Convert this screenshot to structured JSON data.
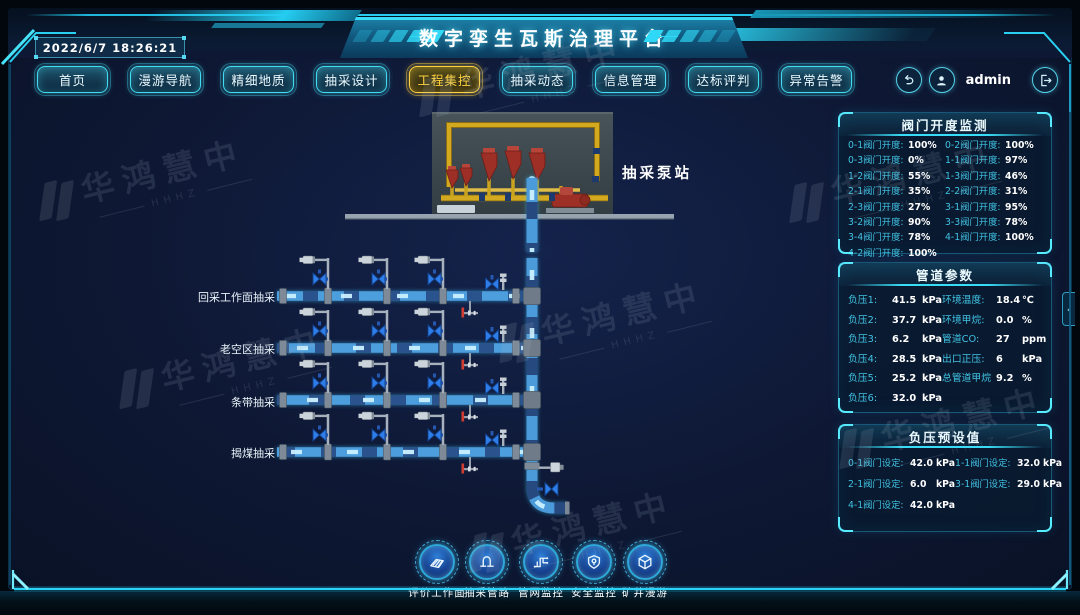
{
  "app": {
    "title": "数字孪生瓦斯治理平台",
    "timestamp": "2022/6/7 18:26:21",
    "user": "admin"
  },
  "nav": {
    "items": [
      {
        "label": "首页"
      },
      {
        "label": "漫游导航"
      },
      {
        "label": "精细地质"
      },
      {
        "label": "抽采设计"
      },
      {
        "label": "工程集控",
        "active": true
      },
      {
        "label": "抽采动态"
      },
      {
        "label": "信息管理"
      },
      {
        "label": "达标评判"
      },
      {
        "label": "异常告警"
      }
    ]
  },
  "diagram": {
    "station_label": "抽采泵站",
    "rows": [
      {
        "label": "回采工作面抽采"
      },
      {
        "label": "老空区抽采"
      },
      {
        "label": "条带抽采"
      },
      {
        "label": "揭煤抽采"
      }
    ]
  },
  "panels": {
    "valve_monitor": {
      "title": "阀门开度监测",
      "items": [
        {
          "label": "0-1阀门开度:",
          "value": "100%"
        },
        {
          "label": "0-2阀门开度:",
          "value": "100%"
        },
        {
          "label": "0-3阀门开度:",
          "value": "0%"
        },
        {
          "label": "1-1阀门开度:",
          "value": "97%"
        },
        {
          "label": "1-2阀门开度:",
          "value": "55%"
        },
        {
          "label": "1-3阀门开度:",
          "value": "46%"
        },
        {
          "label": "2-1阀门开度:",
          "value": "35%"
        },
        {
          "label": "2-2阀门开度:",
          "value": "31%"
        },
        {
          "label": "2-3阀门开度:",
          "value": "27%"
        },
        {
          "label": "3-1阀门开度:",
          "value": "95%"
        },
        {
          "label": "3-2阀门开度:",
          "value": "90%"
        },
        {
          "label": "3-3阀门开度:",
          "value": "78%"
        },
        {
          "label": "3-4阀门开度:",
          "value": "78%"
        },
        {
          "label": "4-1阀门开度:",
          "value": "100%"
        },
        {
          "label": "4-2阀门开度:",
          "value": "100%"
        }
      ]
    },
    "pipeline_params": {
      "title": "管道参数",
      "left": [
        {
          "label": "负压1:",
          "value": "41.5",
          "unit": "kPa"
        },
        {
          "label": "负压2:",
          "value": "37.7",
          "unit": "kPa"
        },
        {
          "label": "负压3:",
          "value": "6.2",
          "unit": "kPa"
        },
        {
          "label": "负压4:",
          "value": "28.5",
          "unit": "kPa"
        },
        {
          "label": "负压5:",
          "value": "25.2",
          "unit": "kPa"
        },
        {
          "label": "负压6:",
          "value": "32.0",
          "unit": "kPa"
        }
      ],
      "right": [
        {
          "label": "环境温度:",
          "value": "18.4",
          "unit": "℃"
        },
        {
          "label": "环境甲烷:",
          "value": "0.0",
          "unit": "%"
        },
        {
          "label": "管道CO:",
          "value": "27",
          "unit": "ppm"
        },
        {
          "label": "出口正压:",
          "value": "6",
          "unit": "kPa"
        },
        {
          "label": "总管道甲烷",
          "value": "9.2",
          "unit": "%"
        }
      ]
    },
    "pressure_presets": {
      "title": "负压预设值",
      "items": [
        {
          "label": "0-1阀门设定:",
          "value": "42.0",
          "unit": "kPa"
        },
        {
          "label": "1-1阀门设定:",
          "value": "32.0",
          "unit": "kPa"
        },
        {
          "label": "2-1阀门设定:",
          "value": "6.0",
          "unit": "kPa"
        },
        {
          "label": "3-1阀门设定:",
          "value": "29.0",
          "unit": "kPa"
        },
        {
          "label": "4-1阀门设定:",
          "value": "42.0",
          "unit": "kPa"
        }
      ]
    }
  },
  "dock": {
    "items": [
      {
        "label": "评价工作面"
      },
      {
        "label": "抽采管路"
      },
      {
        "label": "管网监控"
      },
      {
        "label": "安全监控"
      },
      {
        "label": "矿井漫游"
      }
    ]
  },
  "watermark": {
    "text": "华鸿慧中",
    "sub": "HHHZ"
  },
  "ui": {
    "collapse_glyph": "‹"
  },
  "colors": {
    "accent": "#2cd4f4",
    "active_nav": "#ffd23e",
    "panel_label": "#41c3e3",
    "pipe_glow": "#57b2f2",
    "valve_blue": "#2f7de8",
    "alarm_red": "#d23c30",
    "station_pipe_yellow": "#d2a91f"
  }
}
